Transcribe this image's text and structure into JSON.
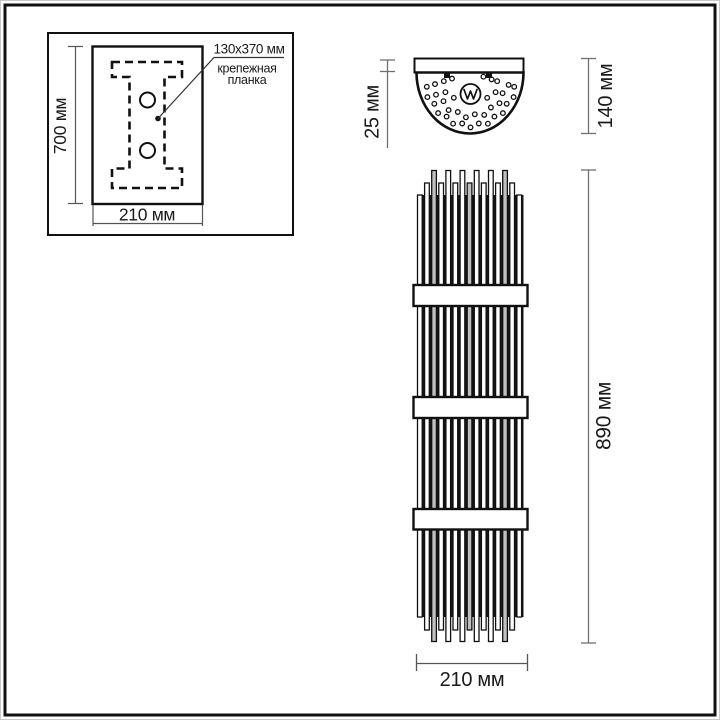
{
  "drawing": {
    "type": "technical-dimension-drawing",
    "units": "мм"
  },
  "inset_panel": {
    "callout": {
      "line1": "130x370 мм",
      "line2": "крепежная",
      "line3": "планка"
    },
    "height_label": "700 мм",
    "width_label": "210 мм",
    "bracket_icon": "dashed-i-beam-mounting-bracket",
    "hole_icon": "screw-hole-circle"
  },
  "top_view": {
    "plate_depth_label": "25 мм",
    "total_depth_label": "140 мм",
    "logo_icon": "brand-wave-logo",
    "perforation_icon": "perforation-dots",
    "screw_icon": "screw-marks"
  },
  "front_view": {
    "height_label": "890 мм",
    "width_label": "210 мм",
    "body_icon": "glass-rod-column",
    "band_icon": "metal-band-ring"
  },
  "colors": {
    "ink": "#161616",
    "dim_line": "#707070",
    "background": "#ffffff",
    "frame": "#111111",
    "rod_gray": "#c0c0c0"
  }
}
